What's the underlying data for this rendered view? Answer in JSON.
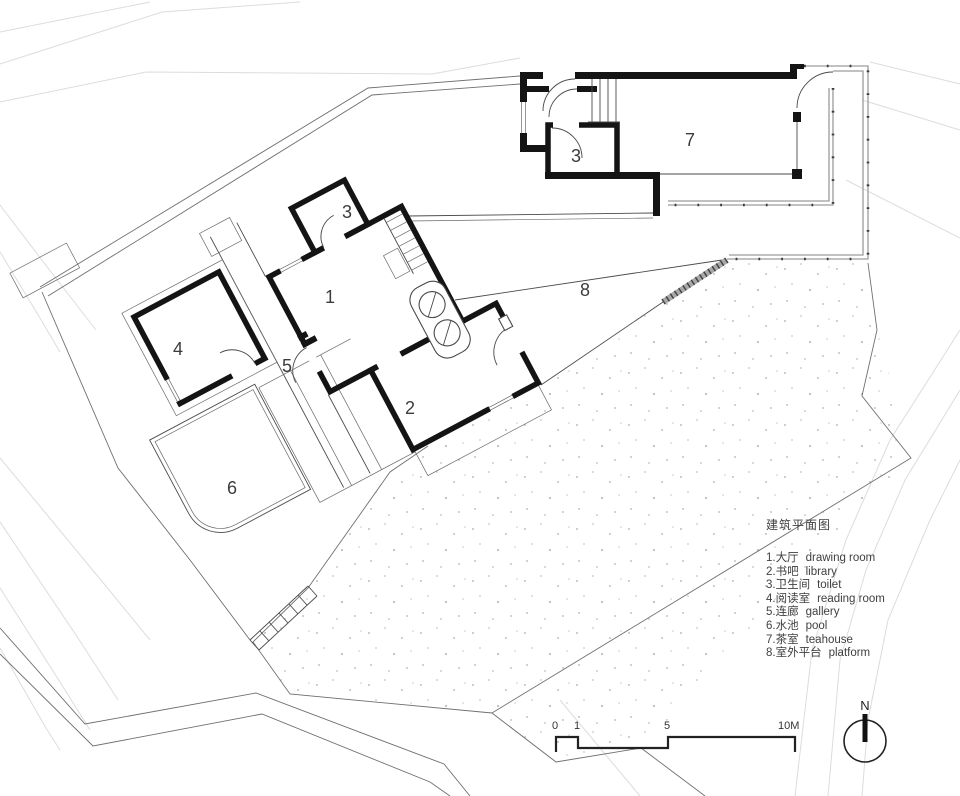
{
  "legend": {
    "title": "建筑平面图",
    "items": [
      {
        "zh": "1.大厅",
        "en": "drawing room"
      },
      {
        "zh": "2.书吧",
        "en": "library"
      },
      {
        "zh": "3.卫生间",
        "en": "toilet"
      },
      {
        "zh": "4.阅读室",
        "en": "reading room"
      },
      {
        "zh": "5.连廊",
        "en": "gallery"
      },
      {
        "zh": "6.水池",
        "en": "pool"
      },
      {
        "zh": "7.茶室",
        "en": "teahouse"
      },
      {
        "zh": "8.室外平台",
        "en": "platform"
      }
    ]
  },
  "rooms": [
    {
      "number": "1",
      "name_zh": "大厅",
      "name_en": "drawing room"
    },
    {
      "number": "2",
      "name_zh": "书吧",
      "name_en": "library"
    },
    {
      "number": "3",
      "name_zh": "卫生间",
      "name_en": "toilet"
    },
    {
      "number": "4",
      "name_zh": "阅读室",
      "name_en": "reading room"
    },
    {
      "number": "5",
      "name_zh": "连廊",
      "name_en": "gallery"
    },
    {
      "number": "6",
      "name_zh": "水池",
      "name_en": "pool"
    },
    {
      "number": "7",
      "name_zh": "茶室",
      "name_en": "teahouse"
    },
    {
      "number": "8",
      "name_zh": "室外平台",
      "name_en": "platform"
    }
  ],
  "scale_bar": {
    "labels": [
      "0",
      "1",
      "5",
      "10M"
    ]
  },
  "north": {
    "label": "N"
  },
  "colors": {
    "wall": "#141414",
    "thin_line": "#4a4a4a",
    "site_line": "#6f6f6f",
    "contour": "#dcdcdc",
    "deck_edge": "#9c9c9c",
    "stipple_dot": "#bfbfbf",
    "label_text": "#3c3c3c"
  }
}
